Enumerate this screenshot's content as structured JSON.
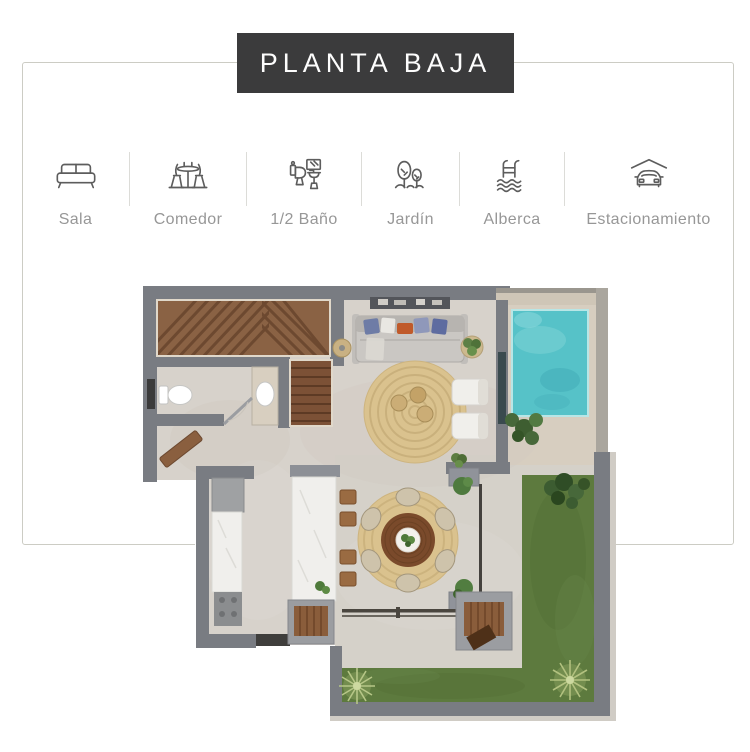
{
  "title": {
    "banner": "PLANTA BAJA"
  },
  "legend": {
    "items": [
      {
        "label": "Sala",
        "icon": "sofa-icon"
      },
      {
        "label": "Comedor",
        "icon": "dining-table-icon"
      },
      {
        "label": "1/2 Baño",
        "icon": "half-bath-icon"
      },
      {
        "label": "Jardín",
        "icon": "garden-trees-icon"
      },
      {
        "label": "Alberca",
        "icon": "pool-ladder-icon"
      },
      {
        "label": "Estacionamiento",
        "icon": "car-garage-icon"
      }
    ]
  },
  "floor_plan": {
    "description": "Top-down 3D render of ground floor: staircase, half bathroom, living room with sofa and round jute rug, pool with deck, kitchen with island and bar stools, round dining table with six chairs, L-shaped grass garden and terrace",
    "areas": [
      "escalera",
      "medio baño",
      "sala",
      "alberca",
      "cocina",
      "comedor",
      "jardín",
      "terraza"
    ],
    "colors": {
      "banner_bg": "#3b3b3c",
      "banner_text": "#fdfdfd",
      "card_border": "#ccccc4",
      "label_text": "#979797",
      "divider": "#dcdcd8",
      "icon_stroke": "#5d5d5d",
      "wall": "#797c82",
      "floor": "#d7d2cb",
      "floor_outdoor": "#d5d1c9",
      "deck": "#d7cec0",
      "pool_water": "#56c2c8",
      "grass": "#5d7a3e",
      "rug": "#dac28e",
      "marble": "#f0efec"
    }
  }
}
